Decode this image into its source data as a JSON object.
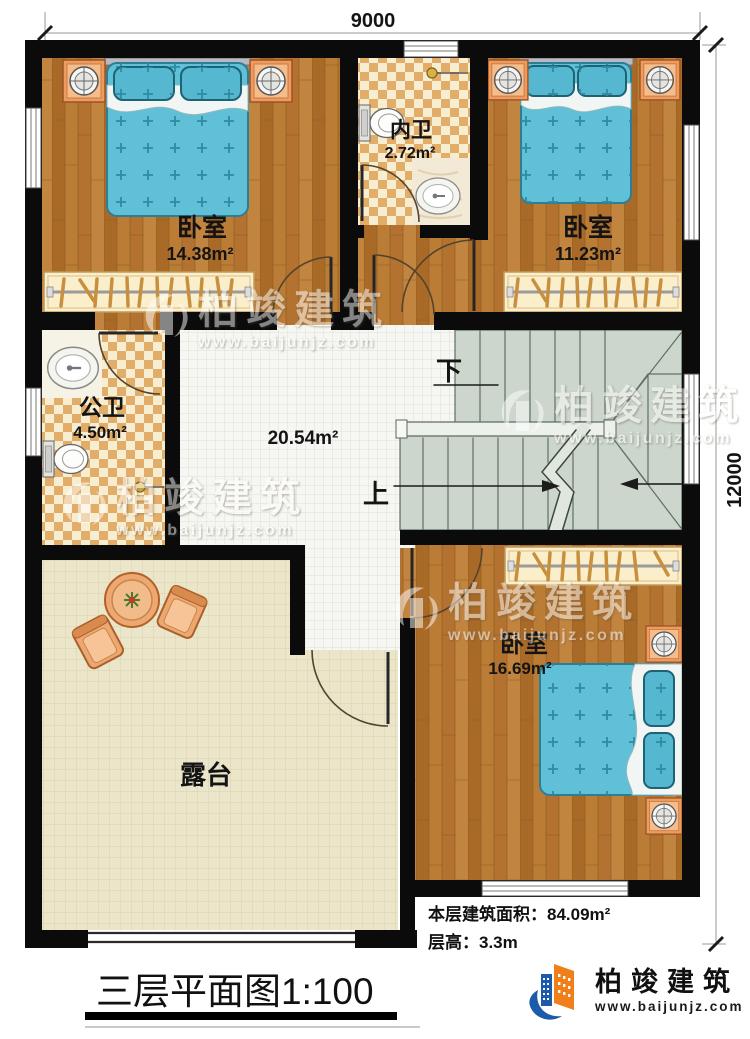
{
  "dimensions": {
    "width_mm": "9000",
    "height_mm": "12000"
  },
  "rooms": {
    "bedroom_top_left": {
      "name": "卧室",
      "area": "14.38m²"
    },
    "inner_bathroom": {
      "name": "内卫",
      "area": "2.72m²"
    },
    "bedroom_top_right": {
      "name": "卧室",
      "area": "11.23m²"
    },
    "public_bathroom": {
      "name": "公卫",
      "area": "4.50m²"
    },
    "hall": {
      "area": "20.54m²"
    },
    "bedroom_bottom_right": {
      "name": "卧室",
      "area": "16.69m²"
    },
    "terrace": {
      "name": "露台"
    }
  },
  "stairs": {
    "up_label": "上",
    "down_label": "下"
  },
  "notes": {
    "floor_area_label": "本层建筑面积：",
    "floor_area_value": "84.09m²",
    "floor_height_label": "层高：",
    "floor_height_value": "3.3m"
  },
  "title": {
    "name": "三层平面图",
    "scale": "1:100"
  },
  "brand": {
    "name": "柏竣建筑",
    "website": "www.baijunjz.com"
  },
  "watermark": {
    "name": "柏竣建筑",
    "website": "www.baijunjz.com"
  },
  "colors": {
    "wall": "#0b0b0b",
    "wood_floor": "#b0712c",
    "bath_tile_light": "#f7eed2",
    "bath_tile_dark": "#e2ad69",
    "hall_tile": "#f6f6f2",
    "terrace_tile": "#ebe5ca",
    "stairs": "#ccd6cc",
    "bed": "#5fc0d8",
    "nightstand": "#ef9a5f",
    "wardrobe": "#faeecb",
    "logo_blue": "#1b5ba9",
    "logo_orange": "#f07f1a"
  }
}
